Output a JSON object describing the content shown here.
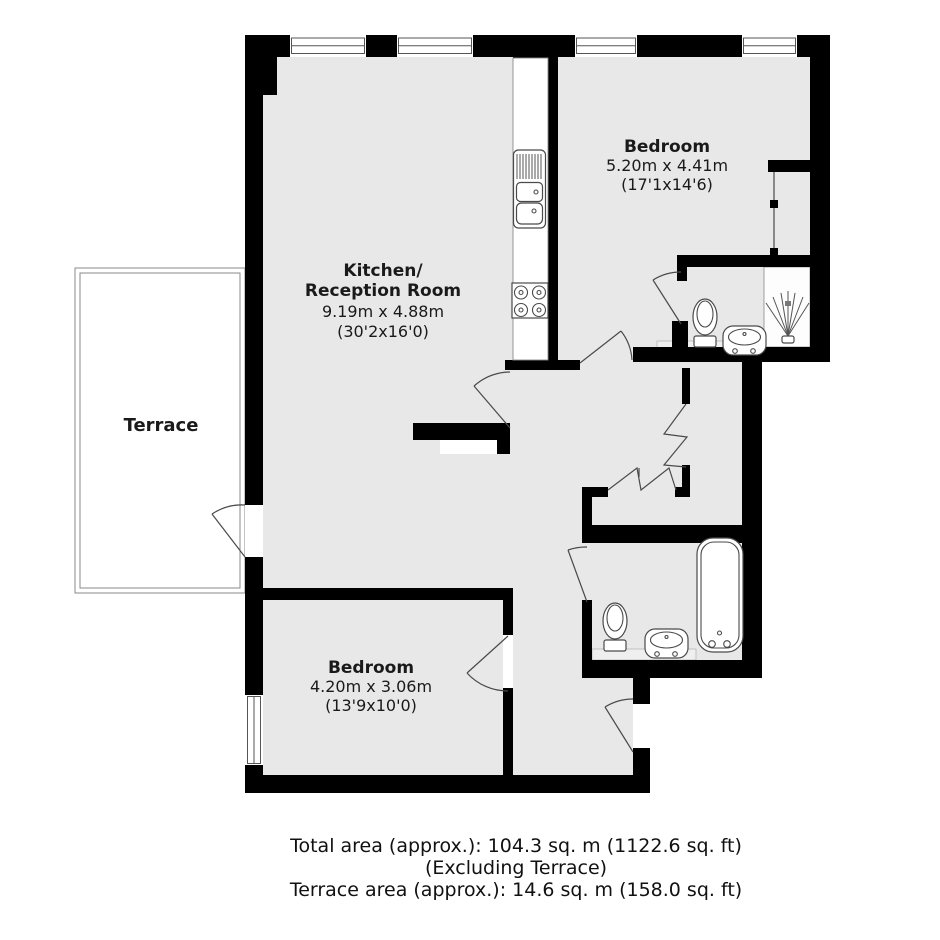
{
  "plan": {
    "rooms": {
      "kitchen_reception": {
        "name_line1": "Kitchen/",
        "name_line2": "Reception Room",
        "dims_metric": "9.19m x 4.88m",
        "dims_imperial": "(30'2x16'0)"
      },
      "bedroom1": {
        "name": "Bedroom",
        "dims_metric": "5.20m x 4.41m",
        "dims_imperial": "(17'1x14'6)"
      },
      "bedroom2": {
        "name": "Bedroom",
        "dims_metric": "4.20m x 3.06m",
        "dims_imperial": "(13'9x10'0)"
      },
      "terrace": {
        "name": "Terrace"
      }
    },
    "fixtures": {
      "kitchen": [
        "drainer-unit",
        "double-sink",
        "hob"
      ],
      "ensuite_bathroom": [
        "toilet",
        "basin",
        "shower"
      ],
      "main_bathroom": [
        "toilet",
        "basin",
        "bathtub"
      ],
      "bedroom1": [
        "wardrobe"
      ]
    },
    "colors": {
      "wall": "#000000",
      "floor": "#e8e8e8",
      "background": "#ffffff",
      "fixture_line": "#4a4a4a"
    }
  },
  "footer": {
    "line1": "Total area (approx.): 104.3 sq. m (1122.6 sq. ft)",
    "line2": "(Excluding Terrace)",
    "line3": "Terrace area (approx.): 14.6 sq. m (158.0 sq. ft)"
  }
}
